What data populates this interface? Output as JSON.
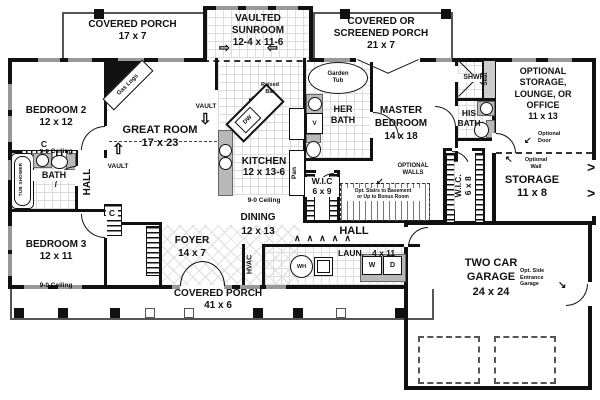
{
  "rooms": {
    "covered_porch_top": {
      "label": "COVERED PORCH\n17 x 7"
    },
    "sunroom": {
      "label": "VAULTED\nSUNROOM\n12-4 x 11-6"
    },
    "screened_porch": {
      "label": "COVERED OR\nSCREENED PORCH\n21 x 7"
    },
    "bedroom2": {
      "label": "BEDROOM 2\n12 x 12",
      "ceiling": "9-0 Ceiling"
    },
    "great_room": {
      "label": "GREAT ROOM\n17 x 23"
    },
    "kitchen": {
      "label": "KITCHEN\n12 x 13-6",
      "ceiling": "9-0 Ceiling"
    },
    "dining": {
      "label": "DINING\n12 x 13"
    },
    "foyer": {
      "label": "FOYER\n14 x 7"
    },
    "bedroom3": {
      "label": "BEDROOM 3\n12 x 11",
      "ceiling": "9-0 Ceiling"
    },
    "bath": {
      "label": "BATH"
    },
    "hall": {
      "label": "HALL"
    },
    "master_bedroom": {
      "label": "MASTER\nBEDROOM\n14 x 18"
    },
    "her_bath": {
      "label": "HER\nBATH"
    },
    "his_bath": {
      "label": "HIS\nBATH"
    },
    "shower": {
      "label": "SHWR.",
      "seat": "Seat"
    },
    "wic_left": {
      "label": "W.I.C\n6 x 9"
    },
    "wic_right": {
      "label": "W.I.C.\n6 x 8"
    },
    "optional_storage": {
      "label": "OPTIONAL\nSTORAGE,\nLOUNGE, OR\nOFFICE\n11 x 13"
    },
    "storage": {
      "label": "STORAGE\n11 x 8"
    },
    "laundry": {
      "label": "LAUN.",
      "dims": "4 x 11"
    },
    "hvac": {
      "label": "HVAC"
    },
    "garage": {
      "label": "TWO CAR\nGARAGE\n24 x 24"
    },
    "covered_porch_bottom": {
      "label": "COVERED PORCH\n41 x 6"
    }
  },
  "ann": {
    "gas_logs": "Gas Logs",
    "garden_tub": "Garden\nTub",
    "raised_bar": "Raised\nBar",
    "vault": "VAULT",
    "pantry": "Pan",
    "dishwasher": "DW",
    "vanity": "V",
    "tub_shower": "TUB SHOWER",
    "closet": "C",
    "optional_walls": "OPTIONAL\nWALLS",
    "opt_stairs": "Opt. Stairs to Basement\nor Up to Bonus Room",
    "optional_door": "Optional\nDoor",
    "optional_wall": "Optional\nWall",
    "opt_side_entrance": "Opt. Side\nEntrance\nGarage",
    "washer": "W",
    "dryer": "D",
    "water_heater": "WH"
  },
  "icons": {
    "vault_up": "⇧",
    "vault_down": "⇩",
    "flow_right": "⇨",
    "flow_left": "⇦",
    "accordion": "∧∧∧∧∧",
    "break_chevron": ">",
    "arrow_dl": "↙",
    "arrow_ul": "↖",
    "arrow_dr": "↘"
  },
  "colors": {
    "wall": "#111111",
    "window": "#999999",
    "counter": "#b9b9b9",
    "tile_line": "#dddddd"
  }
}
